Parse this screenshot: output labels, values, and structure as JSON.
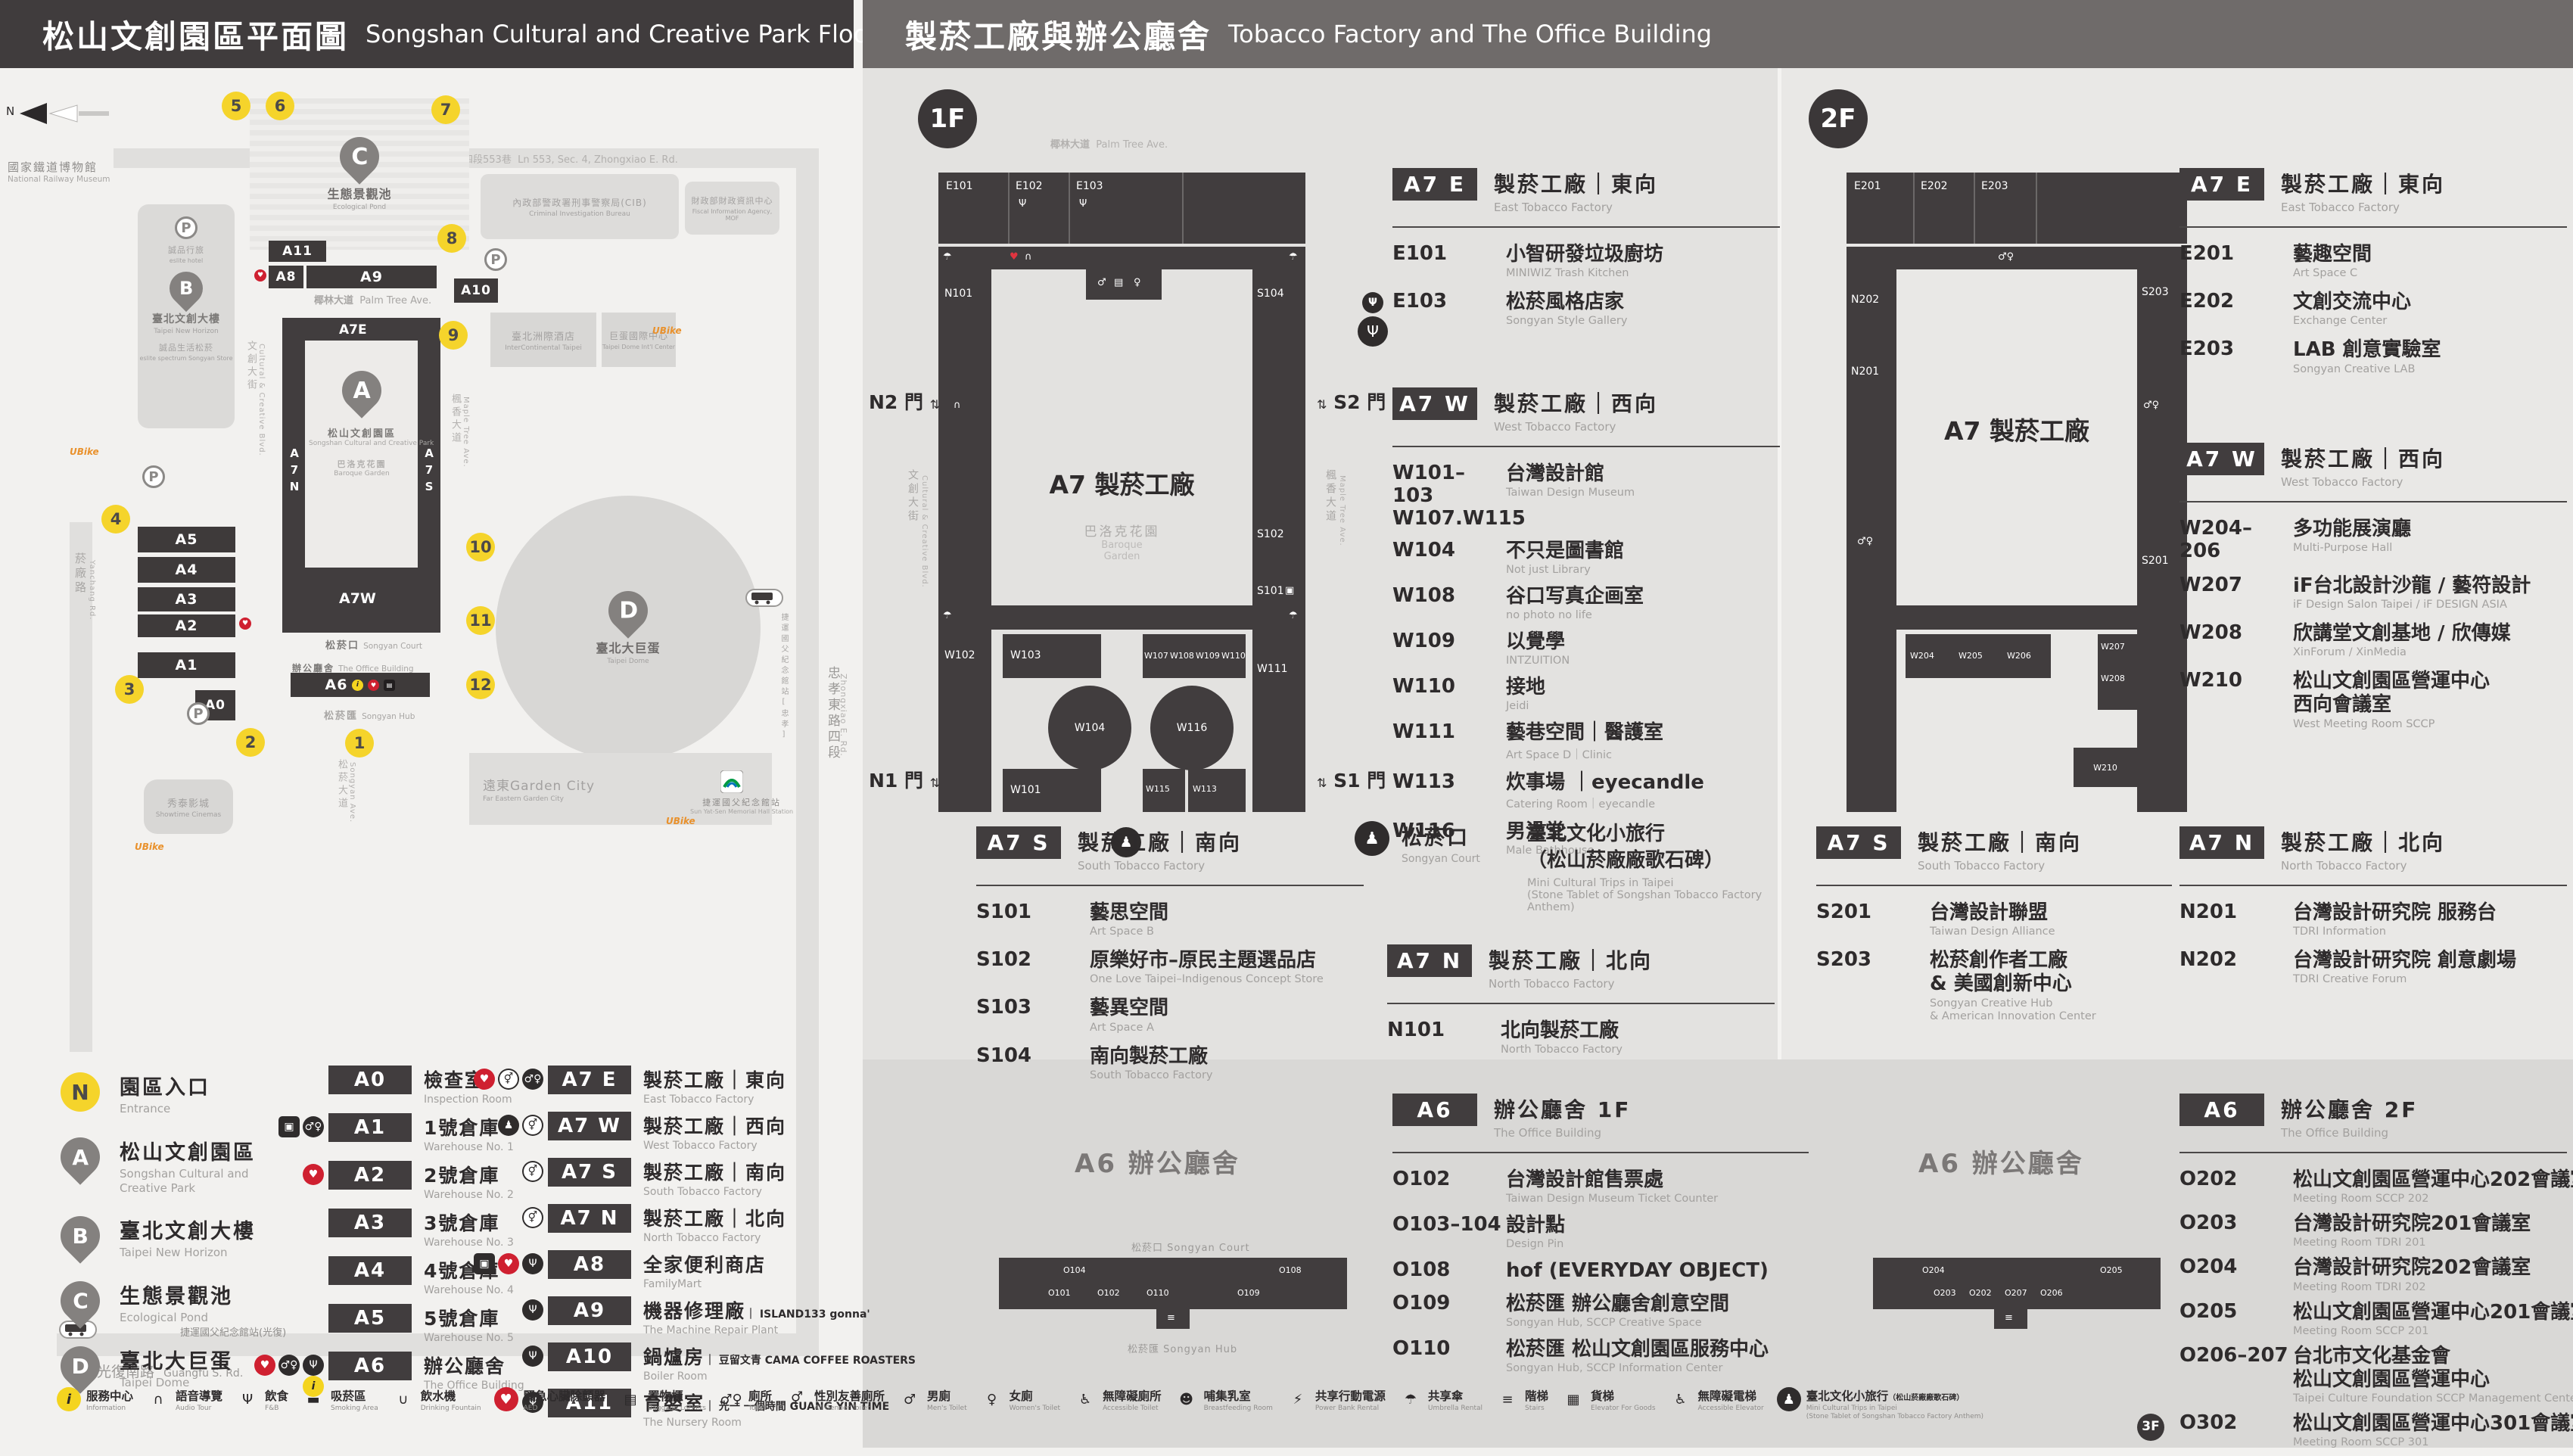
{
  "headers": {
    "left_zh": "松山文創園區平面圖",
    "left_en": "Songshan Cultural and Creative Park Floor Plan",
    "right_zh": "製菸工廠與辦公廳舍",
    "right_en": "Tobacco Factory and The Office Building"
  },
  "icon_glyphs": {
    "information": "i",
    "audio-tour": "∩",
    "fnb": "Ψ",
    "smoking-area": "▬",
    "drinking-fountain": "∪",
    "aed": "♥",
    "baggage-lockers": "▤",
    "toilet": "♂♀",
    "all-gender-toilet": "⚥",
    "mens-toilet": "♂",
    "womens-toilet": "♀",
    "accessible-toilet": "♿",
    "breastfeeding-room": "☻",
    "power-bank-rental": "⚡",
    "umbrella-rental": "☂",
    "stairs": "≡",
    "elevator-for-goods": "▦",
    "accessible-elevator": "♿",
    "mini-trips": "♟",
    "elevator": "▣"
  },
  "map": {
    "north": "N",
    "entrances": [
      "1",
      "2",
      "3",
      "4",
      "5",
      "6",
      "7",
      "8",
      "9",
      "10",
      "11",
      "12"
    ],
    "roads": {
      "top_zh": "忠孝東路四段553巷",
      "top_en": "Ln 553, Sec. 4, Zhongxiao E. Rd.",
      "right_zh": "忠孝東路四段",
      "right_en": "Zhongxiao E. Rd.",
      "bottom_zh": "光復南路",
      "bottom_en": "Guangfu S. Rd.",
      "left_zh": "菸廠路",
      "left_en": "Yanchang Rd.",
      "palm_zh": "椰林大道",
      "palm_en": "Palm Tree Ave.",
      "maple_zh": "楓香大道",
      "maple_en": "Maple Tree Ave.",
      "ccblvd_zh": "文創大街",
      "ccblvd_en": "Cultural & Creative Blvd.",
      "plaza_zh": "文化廣場",
      "plaza_en": "Cultural Plaza",
      "songyan_zh": "松菸大道",
      "songyan_en": "Songyan Ave."
    },
    "landmarks": {
      "railway_zh": "國家鐵道博物館",
      "railway_en": "National Railway Museum",
      "pond_zh": "生態景觀池",
      "pond_en": "Ecological Pond",
      "newhorizon_zh": "臺北文創大樓",
      "newhorizon_en": "Taipei New Horizon",
      "eslite_hotel": "誠品行旅",
      "eslite_hotel_en": "eslite hotel",
      "eslite_spectrum": "誠品生活松菸",
      "eslite_spectrum_en": "eslite spectrum Songyan Store",
      "dome_zh": "臺北大巨蛋",
      "dome_en": "Taipei Dome",
      "showtime_zh": "秀泰影城",
      "showtime_en": "Showtime Cinemas",
      "garden_zh": "遠東Garden City",
      "garden_en": "Far Eastern Garden City",
      "intercont_zh": "臺北洲際酒店",
      "intercont_en": "InterContinental Taipei",
      "domeintl_zh": "巨蛋國際中心",
      "domeintl_en": "Taipei Dome Int'l Center",
      "cib_zh": "內政部警政署刑事警察局(CIB)",
      "cib_en": "Criminal Investigation Bureau",
      "fia_zh": "財政部財政資訊中心",
      "fia_en": "Fiscal Information Agency, MOF",
      "mrt_zh": "捷運國父紀念館站",
      "mrt_en": "Sun Yat-Sen Memorial Hall Station",
      "bus_guangfu_zh": "捷運國父紀念館站(光復)",
      "bus_zhongxiao_zh": "捷運國父紀念館站[忠孝]",
      "ubike": "UBike"
    },
    "park": {
      "a7e": "A7E",
      "a7n": "A7N",
      "a7s": "A7S",
      "a7w": "A7W",
      "a_zh": "松山文創園區",
      "a_en": "Songshan Cultural and Creative Park",
      "garden_zh": "巴洛克花園",
      "garden_en": "Baroque Garden",
      "court_zh": "松菸口",
      "court_en": "Songyan Court",
      "office_zh": "辦公廳舍",
      "office_en": "The Office Building",
      "hub_zh": "松菸匯",
      "hub_en": "Songyan Hub",
      "warehouses": [
        "A5",
        "A4",
        "A3",
        "A2",
        "A1"
      ],
      "a0": "A0",
      "a6": "A6",
      "a8": "A8",
      "a9": "A9",
      "a10": "A10",
      "a11": "A11"
    }
  },
  "floor1": {
    "badge": "1F",
    "plan": {
      "street_top_zh": "椰林大道",
      "street_top_en": "Palm Tree Ave.",
      "street_left_zh": "文創大街",
      "street_left_en": "Cultural & Creative Blvd.",
      "street_right_zh": "楓香大道",
      "street_right_en": "Maple Tree Ave.",
      "center": "A7 製菸工廠",
      "garden_zh": "巴洛克花園",
      "garden_en1": "Baroque",
      "garden_en2": "Garden",
      "gates": {
        "n2": "N2 門",
        "s2": "S2 門",
        "n1": "N1 門",
        "s1": "S1 門"
      },
      "rooms_top": [
        "E101",
        "E102",
        "E103"
      ],
      "rooms_left": [
        "N101",
        "W102"
      ],
      "rooms_right": [
        "S104",
        "S102",
        "S101",
        "W111"
      ],
      "rooms_inner": [
        "W103",
        "W107",
        "W108",
        "W109",
        "W110"
      ],
      "rooms_oval": [
        "W104",
        "W116"
      ],
      "rooms_bottom": [
        "W101",
        "W115",
        "W113"
      ]
    },
    "a7e": {
      "badge": "A7 E",
      "zh": "製菸工廠｜東向",
      "en": "East Tobacco Factory",
      "items": [
        {
          "code": "E101",
          "zh": "小智研發垃圾廚坊",
          "en": "MINIWIZ Trash Kitchen"
        },
        {
          "code": "E103",
          "zh": "松菸風格店家",
          "en": "Songyan Style Gallery",
          "icons": [
            "fnb"
          ]
        }
      ]
    },
    "a7w": {
      "badge": "A7 W",
      "zh": "製菸工廠｜西向",
      "en": "West Tobacco Factory",
      "items": [
        {
          "code": "W101–103",
          "code2": "W107.W115",
          "zh": "台灣設計館",
          "en": "Taiwan Design Museum"
        },
        {
          "code": "W104",
          "zh": "不只是圖書館",
          "en": "Not just Library"
        },
        {
          "code": "W108",
          "zh": "谷口写真企画室",
          "en": "no photo no life"
        },
        {
          "code": "W109",
          "zh": "以覺學",
          "en": "INTZUITION"
        },
        {
          "code": "W110",
          "zh": "接地",
          "en": "Jeidi"
        },
        {
          "code": "W111",
          "zh": "藝巷空間｜醫護室",
          "en": "Art Space D｜Clinic"
        },
        {
          "code": "W113",
          "zh": "炊事場 ｜eyecandle",
          "en": "Catering Room｜eyecandle"
        },
        {
          "code": "W116",
          "zh": "男澡堂",
          "en": "Male Bathhouse"
        }
      ]
    },
    "a7s": {
      "badge": "A7 S",
      "zh": "製菸工廠｜南向",
      "en": "South Tobacco Factory",
      "items": [
        {
          "code": "S101",
          "zh": "藝思空間",
          "en": "Art Space B"
        },
        {
          "code": "S102",
          "zh": "原樂好市–原民主題選品店",
          "en": "One Love Taipei–Indigenous Concept Store"
        },
        {
          "code": "S103",
          "zh": "藝異空間",
          "en": "Art Space A"
        },
        {
          "code": "S104",
          "zh": "南向製菸工廠",
          "en": "South Tobacco Factory"
        }
      ]
    },
    "court": {
      "zh": "松菸口",
      "en": "Songyan Court",
      "item_zh1": "臺北文化小旅行",
      "item_zh2": "（松山菸廠廠歌石碑）",
      "item_en1": "Mini Cultural Trips in Taipei",
      "item_en2": "(Stone Tablet of Songshan Tobacco Factory Anthem)"
    },
    "a7n": {
      "badge": "A7 N",
      "zh": "製菸工廠｜北向",
      "en": "North Tobacco Factory",
      "items": [
        {
          "code": "N101",
          "zh": "北向製菸工廠",
          "en": "North Tobacco Factory"
        }
      ]
    },
    "a6": {
      "badge": "A6",
      "zh": "辦公廳舍 1F",
      "en": "The Office Building",
      "items": [
        {
          "code": "O102",
          "zh": "台灣設計館售票處",
          "en": "Taiwan Design Museum Ticket Counter"
        },
        {
          "code": "O103–104",
          "zh": "設計點",
          "en": "Design Pin"
        },
        {
          "code": "O108",
          "zh": "hof (EVERYDAY OBJECT)"
        },
        {
          "code": "O109",
          "zh": "松菸匯 辦公廳舍創意空間",
          "en": "Songyan Hub, SCCP Creative Space"
        },
        {
          "code": "O110",
          "zh": "松菸匯 松山文創園區服務中心",
          "en": "Songyan Hub, SCCP Information Center"
        }
      ]
    },
    "a6plan": {
      "title": "A6 辦公廳舍",
      "court_zh": "松菸口",
      "court_en": "Songyan Court",
      "hub_zh": "松菸匯",
      "hub_en": "Songyan Hub",
      "rooms_top": [
        "O104",
        "O108"
      ],
      "rooms_bottom": [
        "O101",
        "O102",
        "O110",
        "O109"
      ]
    }
  },
  "floor2": {
    "badge": "2F",
    "plan": {
      "center": "A7 製菸工廠",
      "rooms_top": [
        "E201",
        "E202",
        "E203"
      ],
      "rooms_left": [
        "N202",
        "N201"
      ],
      "rooms_right": [
        "S203",
        "S201"
      ],
      "rooms_bottom": [
        "W204",
        "W205",
        "W206"
      ],
      "rooms_right2": [
        "W207",
        "W208"
      ],
      "room_w210": "W210"
    },
    "a7e": {
      "badge": "A7 E",
      "zh": "製菸工廠｜東向",
      "en": "East Tobacco Factory",
      "items": [
        {
          "code": "E201",
          "zh": "藝趣空間",
          "en": "Art Space C"
        },
        {
          "code": "E202",
          "zh": "文創交流中心",
          "en": "Exchange Center"
        },
        {
          "code": "E203",
          "zh": "LAB 創意實驗室",
          "en": "Songyan Creative LAB"
        }
      ]
    },
    "a7w": {
      "badge": "A7 W",
      "zh": "製菸工廠｜西向",
      "en": "West Tobacco Factory",
      "items": [
        {
          "code": "W204–206",
          "zh": "多功能展演廳",
          "en": "Multi-Purpose Hall"
        },
        {
          "code": "W207",
          "zh": "iF台北設計沙龍 / 藝符設計",
          "en": "iF Design Salon Taipei / iF DESIGN ASIA"
        },
        {
          "code": "W208",
          "zh": "欣講堂文創基地 / 欣傳媒",
          "en": "XinForum / XinMedia"
        },
        {
          "code": "W210",
          "zh": "松山文創園區營運中心",
          "zh2": "西向會議室",
          "en": "West Meeting Room SCCP"
        }
      ]
    },
    "a7s": {
      "badge": "A7 S",
      "zh": "製菸工廠｜南向",
      "en": "South Tobacco Factory",
      "items": [
        {
          "code": "S201",
          "zh": "台灣設計聯盟",
          "en": "Taiwan Design Alliance"
        },
        {
          "code": "S203",
          "zh": "松菸創作者工廠",
          "zh2": "& 美國創新中心",
          "en": "Songyan Creative Hub",
          "en2": "& American Innovation Center"
        }
      ]
    },
    "a7n": {
      "badge": "A7 N",
      "zh": "製菸工廠｜北向",
      "en": "North Tobacco Factory",
      "items": [
        {
          "code": "N201",
          "zh": "台灣設計研究院 服務台",
          "en": "TDRI Information"
        },
        {
          "code": "N202",
          "zh": "台灣設計研究院 創意劇場",
          "en": "TDRI Creative Forum"
        }
      ]
    },
    "a6": {
      "badge": "A6",
      "zh": "辦公廳舍 2F",
      "en": "The Office Building",
      "items": [
        {
          "code": "O202",
          "zh": "松山文創園區營運中心202會議室",
          "en": "Meeting Room SCCP 202"
        },
        {
          "code": "O203",
          "zh": "台灣設計研究院201會議室",
          "en": "Meeting Room TDRI 201"
        },
        {
          "code": "O204",
          "zh": "台灣設計研究院202會議室",
          "en": "Meeting Room TDRI 202"
        },
        {
          "code": "O205",
          "zh": "松山文創園區營運中心201會議室",
          "en": "Meeting Room SCCP 201"
        },
        {
          "code": "O206–207",
          "zh": "台北市文化基金會",
          "zh2": "松山文創園區營運中心",
          "en": "Taipei Culture Foundation SCCP Management Center"
        },
        {
          "code": "O302",
          "fbadge": "3F",
          "zh": "松山文創園區營運中心301會議室",
          "en": "Meeting Room SCCP 301"
        }
      ]
    },
    "a6plan": {
      "title": "A6 辦公廳舍",
      "rooms_top": [
        "O204",
        "O205"
      ],
      "rooms_bottom": [
        "O203",
        "O202",
        "O207",
        "O206"
      ]
    }
  },
  "legend": {
    "pins": [
      {
        "key": "N",
        "zh": "園區入口",
        "en": "Entrance"
      },
      {
        "key": "A",
        "zh": "松山文創園區",
        "en": "Songshan Cultural and Creative Park"
      },
      {
        "key": "B",
        "zh": "臺北文創大樓",
        "en": "Taipei New Horizon"
      },
      {
        "key": "C",
        "zh": "生態景觀池",
        "en": "Ecological Pond"
      },
      {
        "key": "D",
        "zh": "臺北大巨蛋",
        "en": "Taipei Dome"
      }
    ],
    "buildings_a": [
      {
        "code": "A0",
        "zh": "檢查室",
        "en": "Inspection Room",
        "icons": []
      },
      {
        "code": "A1",
        "zh": "1號倉庫",
        "en": "Warehouse No. 1",
        "icons": [
          "elevator",
          "toilet"
        ]
      },
      {
        "code": "A2",
        "zh": "2號倉庫",
        "en": "Warehouse No. 2",
        "icons": [
          "aed"
        ]
      },
      {
        "code": "A3",
        "zh": "3號倉庫",
        "en": "Warehouse No. 3",
        "icons": []
      },
      {
        "code": "A4",
        "zh": "4號倉庫",
        "en": "Warehouse No. 4",
        "icons": []
      },
      {
        "code": "A5",
        "zh": "5號倉庫",
        "en": "Warehouse No. 5",
        "icons": []
      },
      {
        "code": "A6",
        "zh": "辦公廳舍",
        "en": "The Office Building",
        "icons": [
          "aed",
          "toilet",
          "fnb",
          "information"
        ]
      }
    ],
    "buildings_b": [
      {
        "code": "A7 E",
        "zh": "製菸工廠｜東向",
        "en": "East Tobacco Factory",
        "icons": [
          "aed",
          "all-gender-toilet",
          "toilet"
        ]
      },
      {
        "code": "A7 W",
        "zh": "製菸工廠｜西向",
        "en": "West Tobacco Factory",
        "icons": [
          "mini-trips",
          "all-gender-toilet"
        ]
      },
      {
        "code": "A7 S",
        "zh": "製菸工廠｜南向",
        "en": "South Tobacco Factory",
        "icons": [
          "all-gender-toilet"
        ]
      },
      {
        "code": "A7 N",
        "zh": "製菸工廠｜北向",
        "en": "North Tobacco Factory",
        "icons": [
          "all-gender-toilet"
        ]
      },
      {
        "code": "A8",
        "zh": "全家便利商店",
        "en": "FamilyMart",
        "icons": [
          "elevator",
          "aed",
          "fnb"
        ]
      },
      {
        "code": "A9",
        "zh": "機器修理廠",
        "brand": "｜ ISLAND133 gonna'",
        "en": "The Machine Repair Plant",
        "icons": [
          "fnb"
        ]
      },
      {
        "code": "A10",
        "zh": "鍋爐房",
        "brand": "｜ 豆留文青 CAMA COFFEE ROASTERS",
        "en": "Boiler Room",
        "icons": [
          "fnb"
        ]
      },
      {
        "code": "A11",
        "zh": "育嬰室",
        "brand": "｜ 光一 一個時間 GUANG YIN TIME",
        "en": "The Nursery Room",
        "icons": [
          "fnb"
        ]
      }
    ]
  },
  "strip": {
    "items": [
      {
        "icons": [
          "information"
        ],
        "zh": "服務中心",
        "en": "Information"
      },
      {
        "icons": [
          "audio-tour"
        ],
        "zh": "語音導覽",
        "en": "Audio Tour"
      },
      {
        "icons": [
          "fnb"
        ],
        "zh": "飲食",
        "en": "F&B"
      },
      {
        "icons": [
          "smoking-area"
        ],
        "zh": "吸菸區",
        "en": "Smoking Area"
      },
      {
        "icons": [
          "drinking-fountain"
        ],
        "zh": "飲水機",
        "en": "Drinking Fountain"
      },
      {
        "icons": [
          "aed"
        ],
        "zh": "緊急心臟除顫器",
        "en": "AED"
      },
      {
        "icons": [
          "baggage-lockers"
        ],
        "zh": "置物櫃",
        "en": "Baggage Lockers"
      },
      {
        "icons": [
          "toilet"
        ],
        "zh": "廁所",
        "en": "Toilet"
      },
      {
        "icons": [
          "all-gender-toilet"
        ],
        "zh": "性別友善廁所",
        "en": "All Gender Toilet"
      },
      {
        "icons": [
          "mens-toilet"
        ],
        "zh": "男廁",
        "en": "Men's Toilet"
      },
      {
        "icons": [
          "womens-toilet"
        ],
        "zh": "女廁",
        "en": "Women's Toilet"
      },
      {
        "icons": [
          "accessible-toilet"
        ],
        "zh": "無障礙廁所",
        "en": "Accessible Toilet"
      },
      {
        "icons": [
          "breastfeeding-room"
        ],
        "zh": "哺集乳室",
        "en": "Breastfeeding Room"
      },
      {
        "icons": [
          "power-bank-rental"
        ],
        "zh": "共享行動電源",
        "en": "Power Bank Rental"
      },
      {
        "icons": [
          "umbrella-rental"
        ],
        "zh": "共享傘",
        "en": "Umbrella Rental"
      },
      {
        "icons": [
          "stairs"
        ],
        "zh": "階梯",
        "en": "Stairs"
      },
      {
        "icons": [
          "elevator-for-goods"
        ],
        "zh": "貨梯",
        "en": "Elevator For Goods"
      },
      {
        "icons": [
          "accessible-elevator"
        ],
        "zh": "無障礙電梯",
        "en": "Accessible Elevator"
      },
      {
        "icons": [
          "mini-trips"
        ],
        "zh": "臺北文化小旅行",
        "zhp": "（松山菸廠廠歌石碑）",
        "en": "Mini Cultural Trips in Taipei",
        "en2": "(Stone Tablet of Songshan Tobacco Factory Anthem)"
      }
    ]
  }
}
